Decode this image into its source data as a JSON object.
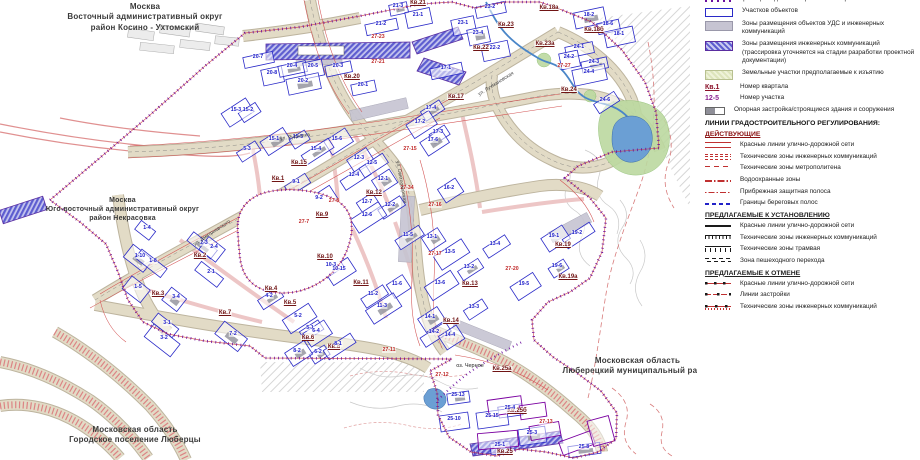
{
  "regions": {
    "moscow_east": {
      "line1": "Москва",
      "line2": "Восточный административный округ",
      "line3": "район Косино - Ухтомский"
    },
    "moscow_southeast": {
      "line1": "Москва",
      "line2": "Юго-восточный административный округ",
      "line3": "район Некрасовка"
    },
    "mo_lyubertsy_city": {
      "line1": "Московская область",
      "line2": "Городское поселение Люберцы"
    },
    "mo_lyubertsy_district": {
      "line1": "Московская область",
      "line2": "Люберецкий муниципальный район"
    }
  },
  "map": {
    "lake_label": "оз. Черное",
    "street_labels": [
      {
        "label": "ул. Святоозерская",
        "x": 401,
        "y": 182,
        "rot": 80
      },
      {
        "label": "ул. Рудневка",
        "x": 295,
        "y": 137,
        "rot": -8
      },
      {
        "label": "ул. Лухмановская",
        "x": 496,
        "y": 84,
        "rot": -32
      },
      {
        "label": "ул. Дмитриевского",
        "x": 212,
        "y": 233,
        "rot": -33
      }
    ],
    "quarters": [
      {
        "label": "Кв.21",
        "x": 418,
        "y": 3
      },
      {
        "label": "Кв.20",
        "x": 352,
        "y": 77
      },
      {
        "label": "Кв.17",
        "x": 456,
        "y": 97
      },
      {
        "label": "Кв.18а",
        "x": 549,
        "y": 8
      },
      {
        "label": "Кв.18б",
        "x": 594,
        "y": 30
      },
      {
        "label": "Кв.23",
        "x": 506,
        "y": 25
      },
      {
        "label": "Кв.23а",
        "x": 545,
        "y": 44
      },
      {
        "label": "Кв.22",
        "x": 481,
        "y": 48
      },
      {
        "label": "Кв.24",
        "x": 569,
        "y": 90
      },
      {
        "label": "Кв.15",
        "x": 299,
        "y": 163
      },
      {
        "label": "Кв.1",
        "x": 278,
        "y": 179
      },
      {
        "label": "Кв.12",
        "x": 374,
        "y": 193
      },
      {
        "label": "Кв.9",
        "x": 322,
        "y": 215
      },
      {
        "label": "Кв.13",
        "x": 470,
        "y": 284
      },
      {
        "label": "Кв.14",
        "x": 451,
        "y": 321
      },
      {
        "label": "Кв.19",
        "x": 563,
        "y": 245
      },
      {
        "label": "Кв.19а",
        "x": 568,
        "y": 277
      },
      {
        "label": "Кв.25а",
        "x": 502,
        "y": 369
      },
      {
        "label": "Кв.25б",
        "x": 517,
        "y": 411
      },
      {
        "label": "Кв.25",
        "x": 505,
        "y": 452
      },
      {
        "label": "Кв.2",
        "x": 200,
        "y": 256
      },
      {
        "label": "Кв.3",
        "x": 158,
        "y": 294
      },
      {
        "label": "Кв.4",
        "x": 271,
        "y": 289
      },
      {
        "label": "Кв.5",
        "x": 290,
        "y": 303
      },
      {
        "label": "Кв.7",
        "x": 225,
        "y": 313
      },
      {
        "label": "Кв.10",
        "x": 325,
        "y": 257
      },
      {
        "label": "Кв.11",
        "x": 361,
        "y": 283
      },
      {
        "label": "Кв.6",
        "x": 308,
        "y": 338
      },
      {
        "label": "Кв.8",
        "x": 334,
        "y": 347
      }
    ],
    "parcels": [
      {
        "label": "21-3",
        "x": 398,
        "y": 6
      },
      {
        "label": "21-1",
        "x": 418,
        "y": 15
      },
      {
        "label": "21-2",
        "x": 381,
        "y": 24
      },
      {
        "label": "27-23",
        "x": 378,
        "y": 37,
        "c": "r"
      },
      {
        "label": "20-7",
        "x": 258,
        "y": 57
      },
      {
        "label": "20-8",
        "x": 272,
        "y": 73
      },
      {
        "label": "20-4",
        "x": 292,
        "y": 66
      },
      {
        "label": "20-5",
        "x": 313,
        "y": 66
      },
      {
        "label": "20-3",
        "x": 338,
        "y": 66
      },
      {
        "label": "20-2",
        "x": 303,
        "y": 81
      },
      {
        "label": "20-1",
        "x": 363,
        "y": 85
      },
      {
        "label": "27-21",
        "x": 378,
        "y": 62,
        "c": "r"
      },
      {
        "label": "17-4",
        "x": 431,
        "y": 108
      },
      {
        "label": "15-3",
        "x": 236,
        "y": 110
      },
      {
        "label": "15-2",
        "x": 248,
        "y": 110
      },
      {
        "label": "15-1",
        "x": 274,
        "y": 139
      },
      {
        "label": "15-5",
        "x": 298,
        "y": 137
      },
      {
        "label": "15-6",
        "x": 337,
        "y": 139
      },
      {
        "label": "15-4",
        "x": 316,
        "y": 149
      },
      {
        "label": "12-3",
        "x": 359,
        "y": 158
      },
      {
        "label": "12-4",
        "x": 354,
        "y": 175
      },
      {
        "label": "12-1",
        "x": 383,
        "y": 179
      },
      {
        "label": "12-5",
        "x": 372,
        "y": 163
      },
      {
        "label": "12-7",
        "x": 367,
        "y": 202
      },
      {
        "label": "12-2",
        "x": 390,
        "y": 205
      },
      {
        "label": "12-6",
        "x": 367,
        "y": 215
      },
      {
        "label": "9-1",
        "x": 296,
        "y": 182
      },
      {
        "label": "9-2",
        "x": 319,
        "y": 198
      },
      {
        "label": "5-3",
        "x": 247,
        "y": 149
      },
      {
        "label": "27-8",
        "x": 334,
        "y": 201,
        "c": "r"
      },
      {
        "label": "27-7",
        "x": 304,
        "y": 222,
        "c": "r"
      },
      {
        "label": "17-2",
        "x": 420,
        "y": 122
      },
      {
        "label": "17-3",
        "x": 438,
        "y": 132
      },
      {
        "label": "17-6",
        "x": 433,
        "y": 140
      },
      {
        "label": "17-1",
        "x": 446,
        "y": 68
      },
      {
        "label": "27-15",
        "x": 410,
        "y": 149,
        "c": "r"
      },
      {
        "label": "27-34",
        "x": 407,
        "y": 188,
        "c": "r"
      },
      {
        "label": "16-2",
        "x": 449,
        "y": 188
      },
      {
        "label": "27-16",
        "x": 435,
        "y": 205,
        "c": "r"
      },
      {
        "label": "13-1",
        "x": 432,
        "y": 237
      },
      {
        "label": "13-4",
        "x": 495,
        "y": 244
      },
      {
        "label": "13-5",
        "x": 450,
        "y": 252
      },
      {
        "label": "13-2",
        "x": 469,
        "y": 267
      },
      {
        "label": "13-6",
        "x": 440,
        "y": 283
      },
      {
        "label": "13-3",
        "x": 474,
        "y": 307
      },
      {
        "label": "27-17",
        "x": 435,
        "y": 254,
        "c": "r"
      },
      {
        "label": "27-20",
        "x": 512,
        "y": 269,
        "c": "r"
      },
      {
        "label": "19-5",
        "x": 524,
        "y": 284
      },
      {
        "label": "19-6",
        "x": 557,
        "y": 266
      },
      {
        "label": "19-1",
        "x": 554,
        "y": 236
      },
      {
        "label": "19-2",
        "x": 577,
        "y": 233
      },
      {
        "label": "14-1",
        "x": 430,
        "y": 317
      },
      {
        "label": "14-2",
        "x": 434,
        "y": 332
      },
      {
        "label": "14-4",
        "x": 450,
        "y": 335
      },
      {
        "label": "11-5",
        "x": 408,
        "y": 235
      },
      {
        "label": "11-6",
        "x": 397,
        "y": 284
      },
      {
        "label": "11-2",
        "x": 373,
        "y": 294
      },
      {
        "label": "11-3",
        "x": 382,
        "y": 306
      },
      {
        "label": "25-4",
        "x": 510,
        "y": 408
      },
      {
        "label": "25-15",
        "x": 492,
        "y": 416
      },
      {
        "label": "25-13",
        "x": 458,
        "y": 395
      },
      {
        "label": "25-10",
        "x": 454,
        "y": 419
      },
      {
        "label": "25-1",
        "x": 500,
        "y": 445
      },
      {
        "label": "25-3",
        "x": 532,
        "y": 433
      },
      {
        "label": "27-12",
        "x": 442,
        "y": 375,
        "c": "r"
      },
      {
        "label": "27-13",
        "x": 546,
        "y": 422,
        "c": "r"
      },
      {
        "label": "25-8",
        "x": 584,
        "y": 447
      },
      {
        "label": "23-1",
        "x": 463,
        "y": 23
      },
      {
        "label": "23-2",
        "x": 490,
        "y": 7
      },
      {
        "label": "23-4",
        "x": 478,
        "y": 33
      },
      {
        "label": "24-1",
        "x": 579,
        "y": 47
      },
      {
        "label": "24-2",
        "x": 569,
        "y": 57
      },
      {
        "label": "24-3",
        "x": 594,
        "y": 62
      },
      {
        "label": "24-4",
        "x": 589,
        "y": 72
      },
      {
        "label": "24-6",
        "x": 605,
        "y": 100
      },
      {
        "label": "18-2",
        "x": 589,
        "y": 15
      },
      {
        "label": "18-6",
        "x": 608,
        "y": 24
      },
      {
        "label": "18-1",
        "x": 619,
        "y": 34
      },
      {
        "label": "27-27",
        "x": 564,
        "y": 66,
        "c": "r"
      },
      {
        "label": "22-2",
        "x": 495,
        "y": 48
      },
      {
        "label": "1-4",
        "x": 147,
        "y": 228
      },
      {
        "label": "1-10",
        "x": 140,
        "y": 256
      },
      {
        "label": "1-8",
        "x": 153,
        "y": 261
      },
      {
        "label": "1-5",
        "x": 138,
        "y": 287
      },
      {
        "label": "2-3",
        "x": 204,
        "y": 243
      },
      {
        "label": "2-4",
        "x": 214,
        "y": 247
      },
      {
        "label": "2-1",
        "x": 211,
        "y": 272
      },
      {
        "label": "3-4",
        "x": 176,
        "y": 297
      },
      {
        "label": "3-1",
        "x": 167,
        "y": 323
      },
      {
        "label": "3-2",
        "x": 164,
        "y": 338
      },
      {
        "label": "4-2",
        "x": 269,
        "y": 296
      },
      {
        "label": "5-2",
        "x": 298,
        "y": 316
      },
      {
        "label": "5-1",
        "x": 310,
        "y": 328
      },
      {
        "label": "7-2",
        "x": 233,
        "y": 334
      },
      {
        "label": "10-3",
        "x": 331,
        "y": 265
      },
      {
        "label": "10-15",
        "x": 339,
        "y": 269
      },
      {
        "label": "6-2",
        "x": 318,
        "y": 352
      },
      {
        "label": "6-4",
        "x": 316,
        "y": 331
      },
      {
        "label": "8-1",
        "x": 338,
        "y": 344
      },
      {
        "label": "8-2",
        "x": 297,
        "y": 351
      },
      {
        "label": "27-11",
        "x": 389,
        "y": 350,
        "c": "r"
      }
    ]
  },
  "legend": {
    "items_top": [
      {
        "swatch": "boundary",
        "label": "Границы подготовки проекта планировки"
      },
      {
        "swatch": "object",
        "label": "Участков объектов"
      },
      {
        "swatch": "uds",
        "label": "Зоны размещения объектов УДС и инженерных коммуникаций"
      },
      {
        "swatch": "comm",
        "label": "Зоны размещения инженерных коммуникаций (трассировка уточняется на стадии разработки проектной документации)"
      },
      {
        "swatch": "seize",
        "label": "Земельные участки предполагаемые к изъятию"
      },
      {
        "swatch": "kv",
        "swatch_text": "Кв.1",
        "label": "Номер квартала"
      },
      {
        "swatch": "uch",
        "swatch_text": "12-5",
        "label": "Номер участка"
      },
      {
        "swatch": "oporn",
        "label": "Опорная застройка/строящиеся здания и сооружения"
      }
    ],
    "lines_header": "ЛИНИИ ГРАДОСТРОИТЕЛЬНОГО РЕГУЛИРОВАНИЯ:",
    "sections": [
      {
        "title": "ДЕЙСТВУЮЩИЕ",
        "items": [
          {
            "swatch": "red-lines",
            "label": "Красные линии улично-дорожной сети"
          },
          {
            "swatch": "red-tech",
            "label": "Технические зоны инженерных коммуникаций"
          },
          {
            "swatch": "red-metro",
            "label": "Технические зоны метрополитена"
          },
          {
            "swatch": "red-water",
            "label": "Водоохранные зоны"
          },
          {
            "swatch": "red-coast",
            "label": "Прибрежная защитная полоса"
          },
          {
            "swatch": "blue-dash",
            "label": "Границы береговых полос"
          }
        ]
      },
      {
        "title": "ПРЕДЛАГАЕМЫЕ К УСТАНОВЛЕНИЮ",
        "items": [
          {
            "swatch": "black-solid",
            "label": "Красные линии улично-дорожной сети"
          },
          {
            "swatch": "black-tech",
            "label": "Технические зоны инженерных коммуникаций"
          },
          {
            "swatch": "black-tram",
            "label": "Технические зоны трамвая"
          },
          {
            "swatch": "black-ped",
            "label": "Зона пешеходного перехода"
          }
        ]
      },
      {
        "title": "ПРЕДЛАГАЕМЫЕ К ОТМЕНЕ",
        "items": [
          {
            "swatch": "cancel-red",
            "label": "Красные линии улично-дорожной сети"
          },
          {
            "swatch": "cancel-build",
            "label": "Линии застройки"
          },
          {
            "swatch": "cancel-tech",
            "label": "Технические зоны инженерных коммуникаций"
          }
        ]
      }
    ]
  }
}
